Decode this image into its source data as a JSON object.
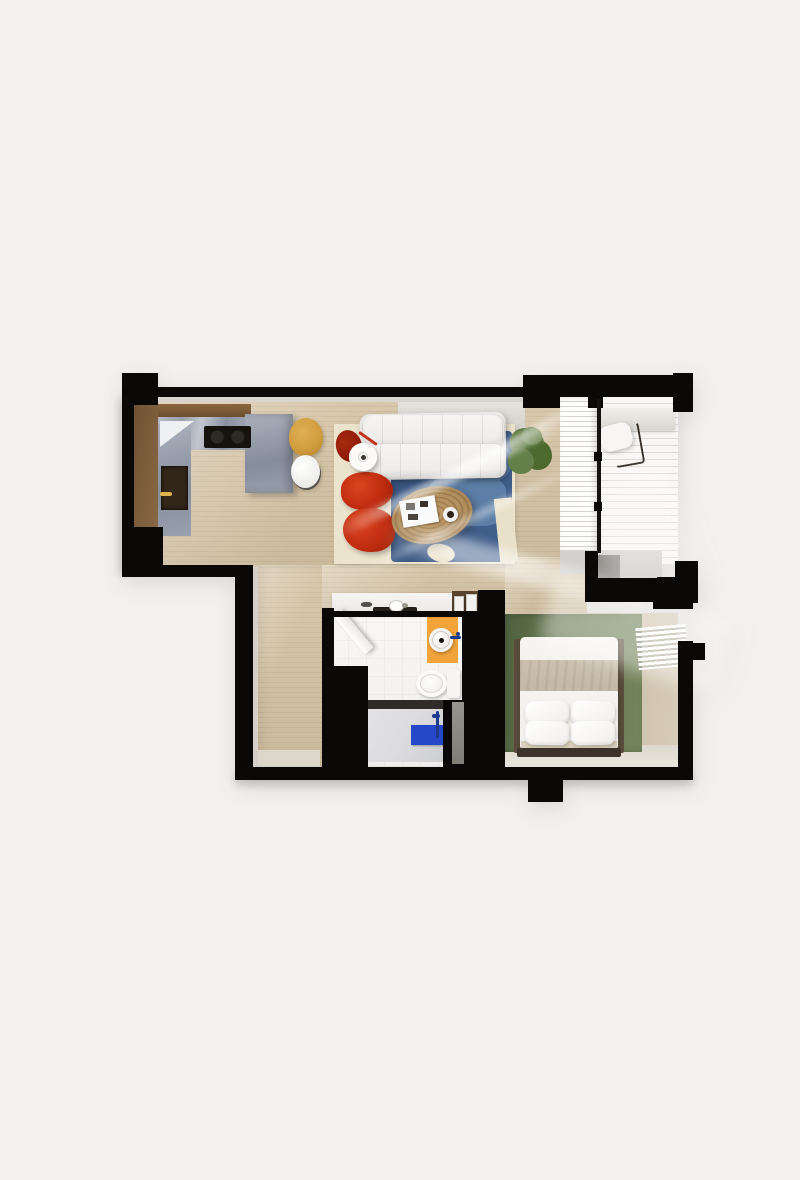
{
  "scene": {
    "type": "3d-rendered-apartment-floor-plan-top-view",
    "background": "#f3f1ee",
    "rooms": [
      "living-room",
      "kitchen",
      "hallway",
      "bathroom",
      "bedroom",
      "balcony"
    ]
  },
  "palette": {
    "bg": "#f3f1ee",
    "wall": "#0b0907",
    "woodLight": "#d8c8ac",
    "woodMid": "#cbba9c",
    "woodDark": "#6f5233",
    "cabinetBrown": "#7d5b39",
    "cooktop": "#16130f",
    "chairMustard": "#cf9b3c",
    "handleYellow": "#ddb24a",
    "beanRed": "#c02c10",
    "beanDarkRed": "#8d1806",
    "lampRed": "#c2331c",
    "rugCream": "#ece3cd",
    "rugNavy": "#3f5e8a",
    "rugBlue": "#5d7ea6",
    "sofaWhite": "#f5f4f2",
    "tableWood": "#b08e5d",
    "plantGreen": "#567238",
    "blindsWhite": "#fdfdfc",
    "slatLine": "#dedbd6",
    "tileWhite": "#f8f7f6",
    "matOrange": "#f2a43a",
    "matBlue": "#2448c8",
    "showerDark": "#2e2b28",
    "showerFloor": "#dadadc",
    "fixtureBlue": "#1d3a8f",
    "vanityWood": "#4a3827",
    "bedWhite": "#f3f1ee",
    "bedBand": "#ccc1af",
    "benchDark": "#3c332a",
    "rugGreen": "#64764b",
    "bedroomFloor": "#d3c6b0",
    "glassGrey": "#c9c6c1"
  }
}
